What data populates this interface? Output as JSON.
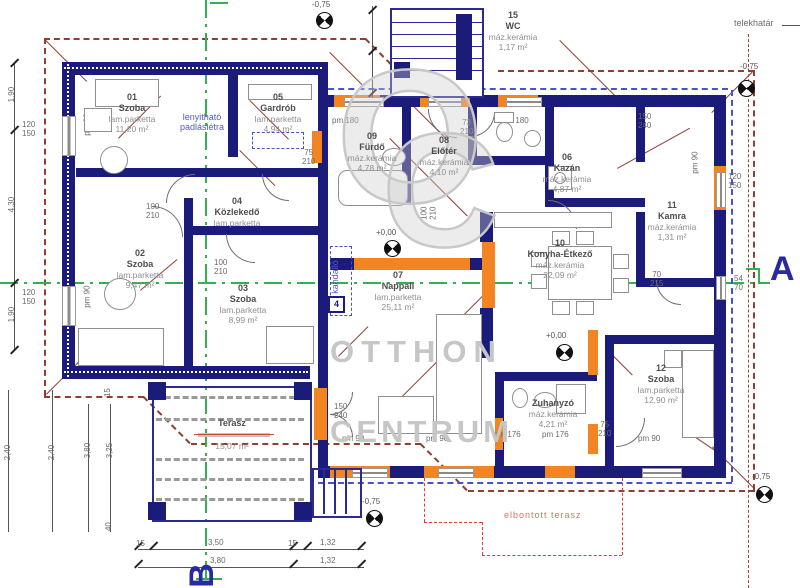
{
  "plan": {
    "rooms": [
      {
        "num": "01",
        "name": "Szoba",
        "floor": "lam.parketta",
        "area": "11,20 m²"
      },
      {
        "num": "02",
        "name": "Szoba",
        "floor": "lam.parketta",
        "area": "9,47 m²"
      },
      {
        "num": "03",
        "name": "Szoba",
        "floor": "lam.parketta",
        "area": "8,99 m²"
      },
      {
        "num": "04",
        "name": "Közlekedő",
        "floor": "lam.parketta",
        "area": "3,84 m²"
      },
      {
        "num": "05",
        "name": "Gardrób",
        "floor": "lam.parketta",
        "area": "4,94 m²"
      },
      {
        "num": "06",
        "name": "Kazán",
        "floor": "máz.kerámia",
        "area": "4,87 m²"
      },
      {
        "num": "07",
        "name": "Nappali",
        "floor": "lam.parketta",
        "area": "25,11 m²"
      },
      {
        "num": "08",
        "name": "Előtér",
        "floor": "máz.kerámia",
        "area": "4,10 m²"
      },
      {
        "num": "09",
        "name": "Fürdő",
        "floor": "máz.kerámia",
        "area": "4,78 m²"
      },
      {
        "num": "10",
        "name": "Konyha-Étkező",
        "floor": "máz.kerámia",
        "area": "22,09 m²"
      },
      {
        "num": "11",
        "name": "Kamra",
        "floor": "máz.kerámia",
        "area": "1,31 m²"
      },
      {
        "num": "12",
        "name": "Szoba",
        "floor": "lam.parketta",
        "area": "12,90 m²"
      },
      {
        "num": "",
        "name": "Zuhanyzó",
        "floor": "máz.kerámia",
        "area": "4,21 m²"
      },
      {
        "num": "15",
        "name": "WC",
        "floor": "máz.kerámia",
        "area": "1,17 m²"
      },
      {
        "num": "",
        "name": "Terasz",
        "floor": "",
        "area": "15,07 m²"
      }
    ],
    "annotations": {
      "telekhatar": "telekhatár",
      "elbontott": "elbontott terasz",
      "padlasletra": "lenyitható\npadláslétra",
      "kandallo": "kandalló",
      "section_a": "A",
      "section_b": "B",
      "marker4": "4"
    },
    "levels": {
      "zero": "+0,00",
      "minus": "-0,75"
    },
    "dims": {
      "v190": "1,90",
      "v430": "4,30",
      "v240": "2,40",
      "v380": "3,80",
      "v325": "3,25",
      "v40": "40",
      "v15": "15",
      "b15": "15",
      "b350": "3,50",
      "b132": "1,32",
      "b380": "3,80",
      "pm90": "pm 90",
      "pm176": "pm 176",
      "pm180": "pm 180",
      "d120150": "120\n150",
      "d100210": "100\n210",
      "d75210": "75\n210",
      "d73210": "73\n210",
      "d90210": "90\n210",
      "d70215": "70\n215",
      "d5470": "54\n70",
      "d150240": "150\n240",
      "s150": "150",
      "s240": "240"
    },
    "watermark": {
      "logo_o": "O",
      "logo_c": "C",
      "line1": "OTTHON",
      "line2": "CENTRUM"
    }
  }
}
